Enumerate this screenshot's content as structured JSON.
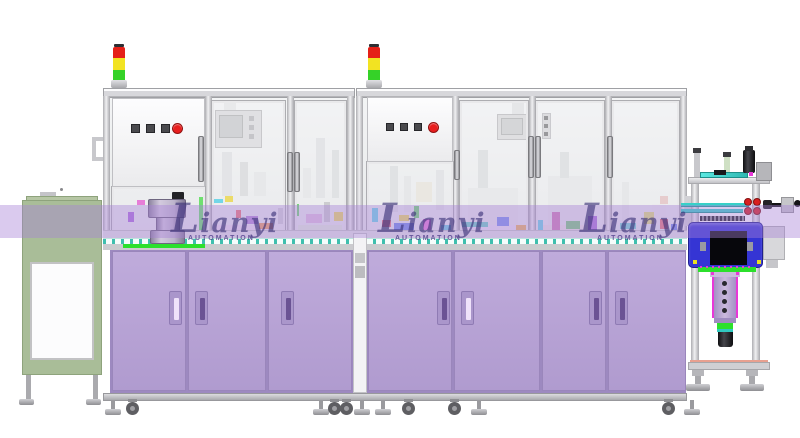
{
  "scene": {
    "description": "Side-elevation 3D CAD render of an industrial automation assembly machine line",
    "background": "#ffffff"
  },
  "watermark": {
    "brand": "Lianyi",
    "subtitle": "AUTOMATION",
    "band": {
      "y": 205,
      "height": 33,
      "color": "rgba(166,128,214,0.42)"
    },
    "text_color": "rgba(56,46,118,0.62)",
    "subtitle_color": "rgba(74,58,134,0.78)",
    "instances": [
      {
        "x": 171,
        "y": 206
      },
      {
        "x": 378,
        "y": 206
      },
      {
        "x": 580,
        "y": 206
      }
    ]
  },
  "palette": {
    "frame_light": "#f4f4f6",
    "frame_gray": "#d3d3d7",
    "frame_dark": "#a8a8ac",
    "glass": "#eef0f1",
    "cabinet_purple": "#b7a2d6",
    "cabinet_purple_dark": "#9d89c0",
    "handle_slot_dark": "#6b5394",
    "handle_slot_light": "#efe2fa",
    "green_cabinet": "#a9bd98",
    "deck_teal": "#3fbfae",
    "accent_green": "#2ce02c",
    "signal_red": "#e52018",
    "signal_yellow": "#f2e322",
    "signal_green": "#35d228",
    "estop_red": "#e81e1e",
    "button_dark": "#4a4a4e",
    "station_blue": "#3535d4",
    "camera_purple": "#b9a4d8",
    "magenta": "#e838d8",
    "tube_teal": "#38d0c8",
    "salmon": "#e8a090"
  },
  "signal_towers": [
    {
      "x": 111
    },
    {
      "x": 366
    }
  ],
  "window_handles": [
    {
      "x": 287,
      "y": 152,
      "h": 40
    },
    {
      "x": 294,
      "y": 152,
      "h": 40
    },
    {
      "x": 454,
      "y": 150,
      "h": 30
    },
    {
      "x": 528,
      "y": 136,
      "h": 42
    },
    {
      "x": 535,
      "y": 136,
      "h": 42
    },
    {
      "x": 607,
      "y": 136,
      "h": 42
    }
  ],
  "cabinet_doors": [
    {
      "x": 112,
      "w": 74,
      "handle_x": 168,
      "handle_light": true
    },
    {
      "x": 188,
      "w": 78,
      "handle_x": 194,
      "handle_light": false
    },
    {
      "x": 268,
      "w": 84,
      "handle_x": 280,
      "handle_light": false
    },
    {
      "x": 368,
      "w": 84,
      "handle_x": 436,
      "handle_light": false
    },
    {
      "x": 454,
      "w": 86,
      "handle_x": 460,
      "handle_light": true
    },
    {
      "x": 542,
      "w": 64,
      "handle_x": 588,
      "handle_light": false
    },
    {
      "x": 608,
      "w": 78,
      "handle_x": 614,
      "handle_light": false
    }
  ],
  "feet": [
    {
      "x": 105,
      "type": "level"
    },
    {
      "x": 126,
      "type": "caster"
    },
    {
      "x": 313,
      "type": "level"
    },
    {
      "x": 328,
      "type": "caster"
    },
    {
      "x": 340,
      "type": "caster"
    },
    {
      "x": 354,
      "type": "level"
    },
    {
      "x": 375,
      "type": "level"
    },
    {
      "x": 402,
      "type": "caster"
    },
    {
      "x": 448,
      "type": "caster"
    },
    {
      "x": 471,
      "type": "level"
    },
    {
      "x": 662,
      "type": "caster"
    },
    {
      "x": 684,
      "type": "level"
    }
  ],
  "silhouettes": [
    {
      "x": 222,
      "y": 152,
      "w": 10,
      "h": 44,
      "c": "#dcdee0"
    },
    {
      "x": 240,
      "y": 162,
      "w": 8,
      "h": 34,
      "c": "#d4d6d8"
    },
    {
      "x": 254,
      "y": 172,
      "w": 12,
      "h": 24,
      "c": "#e2e3e5"
    },
    {
      "x": 316,
      "y": 138,
      "w": 9,
      "h": 60,
      "c": "#dcdee0"
    },
    {
      "x": 303,
      "y": 168,
      "w": 8,
      "h": 30,
      "c": "#e2e3e5"
    },
    {
      "x": 332,
      "y": 150,
      "w": 7,
      "h": 48,
      "c": "#d8dadc"
    },
    {
      "x": 390,
      "y": 166,
      "w": 8,
      "h": 46,
      "c": "#d8dadc"
    },
    {
      "x": 404,
      "y": 176,
      "w": 7,
      "h": 36,
      "c": "#e0e2e4"
    },
    {
      "x": 416,
      "y": 182,
      "w": 16,
      "h": 20,
      "c": "#e6e2d8"
    },
    {
      "x": 436,
      "y": 170,
      "w": 8,
      "h": 40,
      "c": "#dcdee0"
    },
    {
      "x": 468,
      "y": 188,
      "w": 50,
      "h": 38,
      "c": "#e4e5e7"
    },
    {
      "x": 478,
      "y": 150,
      "w": 10,
      "h": 38,
      "c": "#d8dadc"
    },
    {
      "x": 548,
      "y": 176,
      "w": 44,
      "h": 50,
      "c": "#e4e5e7"
    },
    {
      "x": 560,
      "y": 152,
      "w": 9,
      "h": 26,
      "c": "#d8dadc"
    },
    {
      "x": 622,
      "y": 182,
      "w": 7,
      "h": 44,
      "c": "#e0e2e4"
    },
    {
      "x": 652,
      "y": 204,
      "w": 14,
      "h": 22,
      "c": "#e8e6ea"
    },
    {
      "x": 660,
      "y": 196,
      "w": 8,
      "h": 8,
      "c": "#e0b8b8"
    }
  ],
  "floor_strips": [
    {
      "x": 212,
      "y": 225,
      "w": 58,
      "h": 7,
      "c": "#ecd9ec"
    },
    {
      "x": 298,
      "y": 225,
      "w": 44,
      "h": 7,
      "c": "#dcecd4"
    },
    {
      "x": 458,
      "y": 225,
      "w": 66,
      "h": 7,
      "c": "#e6dcf2"
    },
    {
      "x": 540,
      "y": 225,
      "w": 56,
      "h": 7,
      "c": "#ecdcdc"
    },
    {
      "x": 614,
      "y": 225,
      "w": 60,
      "h": 7,
      "c": "#dcece8"
    }
  ],
  "interior_parts": [
    {
      "x": 137,
      "y": 200,
      "w": 8,
      "h": 5,
      "c": "#e040c8"
    },
    {
      "x": 128,
      "y": 212,
      "w": 6,
      "h": 10,
      "c": "#8a30d0"
    },
    {
      "x": 199,
      "y": 197,
      "w": 5,
      "h": 46,
      "c": "#2ad82a"
    },
    {
      "x": 206,
      "y": 200,
      "w": 4,
      "h": 30,
      "c": "#207820"
    },
    {
      "x": 213,
      "y": 199,
      "w": 10,
      "h": 4,
      "c": "#30c8e0"
    },
    {
      "x": 225,
      "y": 196,
      "w": 8,
      "h": 6,
      "c": "#e8d020"
    },
    {
      "x": 236,
      "y": 210,
      "w": 5,
      "h": 8,
      "c": "#e84040"
    },
    {
      "x": 246,
      "y": 216,
      "w": 12,
      "h": 8,
      "c": "#9858c8"
    },
    {
      "x": 259,
      "y": 223,
      "w": 14,
      "h": 6,
      "c": "#e87820"
    },
    {
      "x": 278,
      "y": 208,
      "w": 8,
      "h": 16,
      "c": "#c4c4c8"
    },
    {
      "x": 293,
      "y": 204,
      "w": 6,
      "h": 12,
      "c": "#38c838"
    },
    {
      "x": 306,
      "y": 214,
      "w": 16,
      "h": 9,
      "c": "#d8a8d8"
    },
    {
      "x": 324,
      "y": 202,
      "w": 6,
      "h": 20,
      "c": "#b8b8bc"
    },
    {
      "x": 334,
      "y": 212,
      "w": 9,
      "h": 9,
      "c": "#e8d020"
    },
    {
      "x": 372,
      "y": 208,
      "w": 6,
      "h": 14,
      "c": "#30c8e0"
    },
    {
      "x": 382,
      "y": 220,
      "w": 9,
      "h": 7,
      "c": "#e84040"
    },
    {
      "x": 394,
      "y": 223,
      "w": 20,
      "h": 8,
      "c": "#3858e0"
    },
    {
      "x": 399,
      "y": 215,
      "w": 10,
      "h": 6,
      "c": "#e8d020"
    },
    {
      "x": 414,
      "y": 206,
      "w": 5,
      "h": 12,
      "c": "#38c838"
    },
    {
      "x": 423,
      "y": 219,
      "w": 8,
      "h": 12,
      "c": "#e040c8"
    },
    {
      "x": 441,
      "y": 225,
      "w": 16,
      "h": 6,
      "c": "#30b8d8"
    },
    {
      "x": 462,
      "y": 222,
      "w": 26,
      "h": 5,
      "c": "#30c0b0"
    },
    {
      "x": 497,
      "y": 217,
      "w": 12,
      "h": 9,
      "c": "#4868e8"
    },
    {
      "x": 516,
      "y": 225,
      "w": 10,
      "h": 6,
      "c": "#e89820"
    },
    {
      "x": 536,
      "y": 220,
      "w": 7,
      "h": 10,
      "c": "#30c8e0"
    },
    {
      "x": 552,
      "y": 212,
      "w": 8,
      "h": 18,
      "c": "#c04898"
    },
    {
      "x": 566,
      "y": 221,
      "w": 14,
      "h": 8,
      "c": "#48b848"
    },
    {
      "x": 588,
      "y": 216,
      "w": 9,
      "h": 14,
      "c": "#8838c8"
    },
    {
      "x": 604,
      "y": 224,
      "w": 10,
      "h": 5,
      "c": "#e8d020"
    },
    {
      "x": 620,
      "y": 223,
      "w": 16,
      "h": 6,
      "c": "#3cc8c0"
    },
    {
      "x": 644,
      "y": 212,
      "w": 10,
      "h": 12,
      "c": "#d8d840"
    },
    {
      "x": 660,
      "y": 219,
      "w": 8,
      "h": 10,
      "c": "#e04040"
    },
    {
      "x": 671,
      "y": 224,
      "w": 9,
      "h": 6,
      "c": "#3858e0"
    }
  ]
}
